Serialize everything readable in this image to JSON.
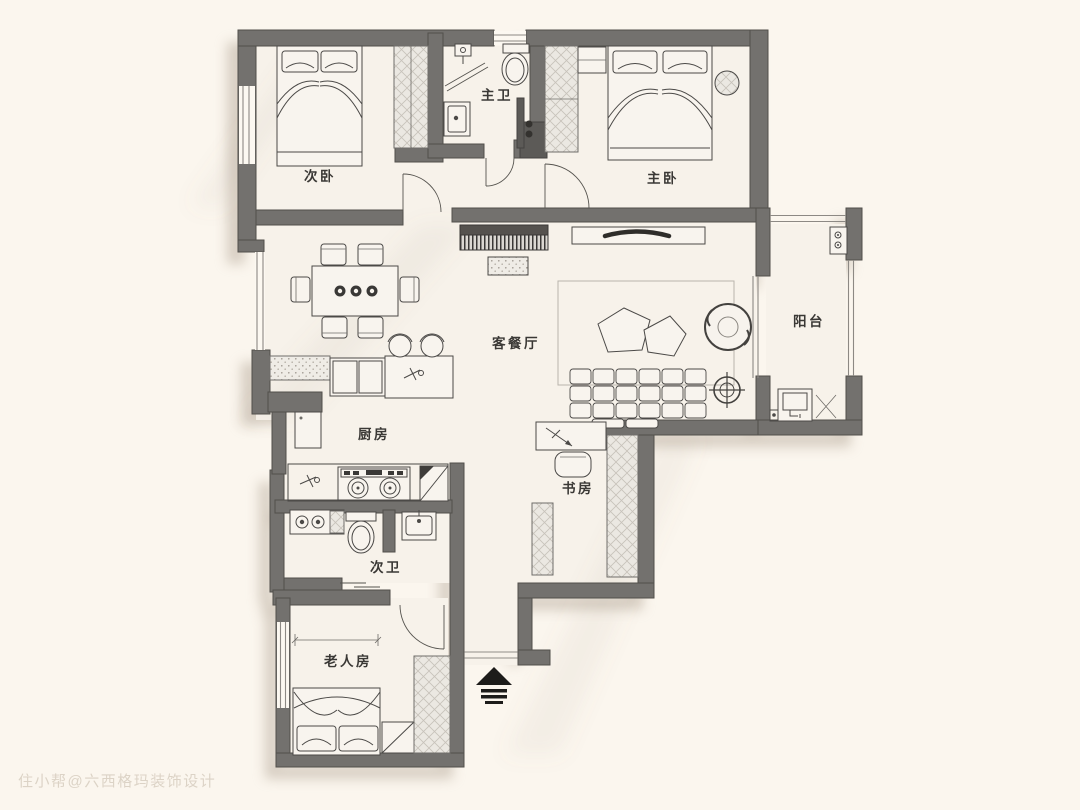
{
  "document": {
    "type": "residential floor plan drawing",
    "orientation_note": "entry at bottom center marked with arrow"
  },
  "colors": {
    "background": "#fbf6ee",
    "floor": "#f7f2ea",
    "wall": "#73716e",
    "wall_outline": "#514f4b",
    "furniture_line": "#4b4947",
    "hatch_fill": "#ebe8e2",
    "dark_accent": "#34322f",
    "shadow": "#b3a696",
    "watermark_text_color": "#c8bcac"
  },
  "rooms": [
    {
      "id": "secondary-bedroom",
      "label": "次卧"
    },
    {
      "id": "master-bathroom",
      "label": "主卫"
    },
    {
      "id": "master-bedroom",
      "label": "主卧"
    },
    {
      "id": "balcony",
      "label": "阳台"
    },
    {
      "id": "living-dining",
      "label": "客餐厅"
    },
    {
      "id": "kitchen",
      "label": "厨房"
    },
    {
      "id": "study",
      "label": "书房"
    },
    {
      "id": "secondary-bathroom",
      "label": "次卫"
    },
    {
      "id": "elderly-room",
      "label": "老人房"
    }
  ],
  "annotations": {
    "watermark": "住小帮@六西格玛装饰设计",
    "entry_symbol": "entrance-arrow"
  }
}
